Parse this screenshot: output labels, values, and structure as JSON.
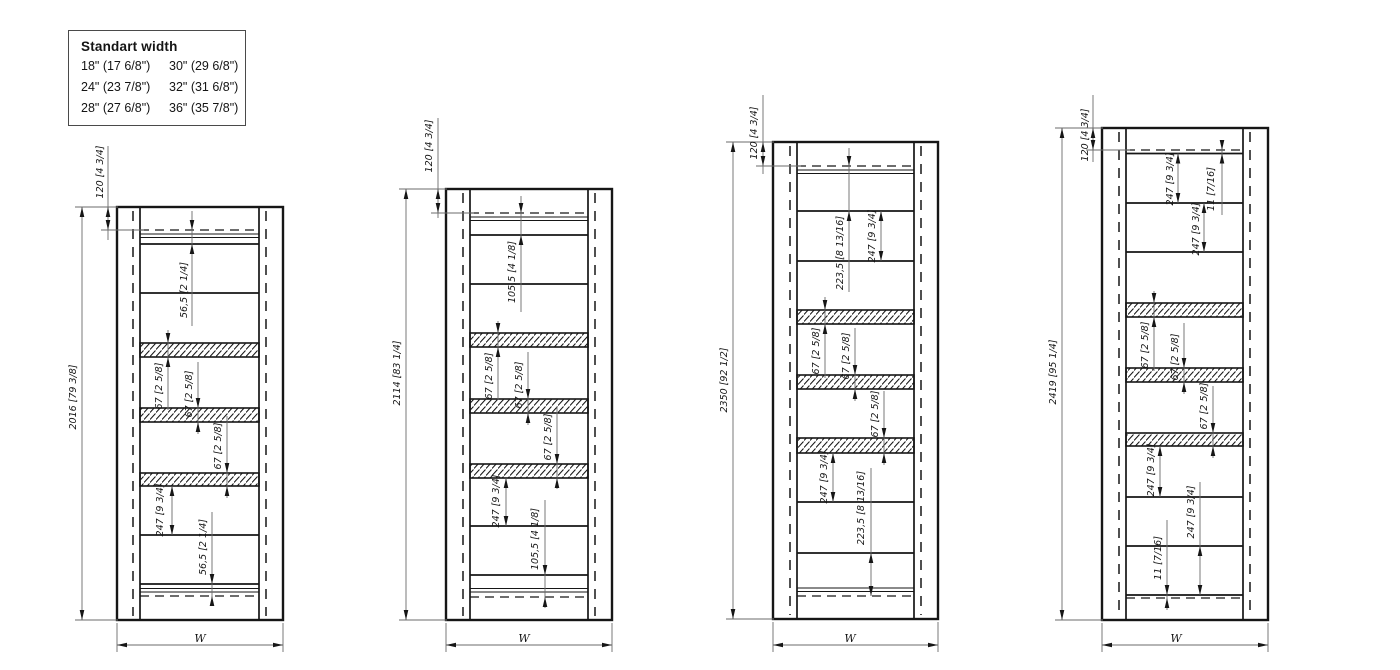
{
  "legend": {
    "title": "Standart width",
    "items": [
      "18\" (17 6/8\")",
      "30\" (29 6/8\")",
      "24\" (23 7/8\")",
      "32\" (31 6/8\")",
      "28\" (27 6/8\")",
      "36\" (35 7/8\")"
    ]
  },
  "drawings": [
    {
      "id": "2016",
      "outer": {
        "x1": 117,
        "y1": 207,
        "x2": 283,
        "y2": 620
      },
      "inner": {
        "x1": 140,
        "x2": 259
      },
      "top": {
        "dashed": 230,
        "strip": [
          234,
          237.5
        ],
        "rail": 244
      },
      "bottom": {
        "rail": 584,
        "strip": [
          588.5,
          592
        ],
        "dashed": 596
      },
      "shelves": [
        293,
        535
      ],
      "bands": [
        [
          343,
          357
        ],
        [
          408,
          422
        ],
        [
          473,
          486
        ]
      ],
      "overall": {
        "label": "2016 [79 3/8]",
        "line_x": 82,
        "text_x": 73,
        "text_cy": 397
      },
      "top_offset": {
        "label": "120 [4 3/4]",
        "line_x": 108,
        "line": [
          146,
          240
        ],
        "text_x": 100,
        "text_cy": 172
      },
      "width_dim": {
        "label": "W",
        "cx": 200,
        "y": 645
      },
      "dims": [
        {
          "label": "56,5 [2 1/4]",
          "line_x": 192,
          "span": [
            230,
            244
          ],
          "mode": "outside",
          "line": [
            211,
            326
          ],
          "text_x": 184,
          "text_cy": 290
        },
        {
          "label": "67 [2 5/8]",
          "line_x": 168,
          "span": [
            343,
            357
          ],
          "mode": "outside",
          "line": [
            330,
            410
          ],
          "text_x": 159,
          "text_cy": 386
        },
        {
          "label": "67 [2 5/8]",
          "line_x": 198,
          "span": [
            408,
            422
          ],
          "mode": "outside",
          "line": [
            362,
            434
          ],
          "text_x": 189,
          "text_cy": 394
        },
        {
          "label": "67 [2 5/8]",
          "line_x": 227,
          "span": [
            473,
            486
          ],
          "mode": "outside",
          "line": [
            416,
            498
          ],
          "text_x": 218,
          "text_cy": 446
        },
        {
          "label": "247 [9 3/4]",
          "line_x": 172,
          "span": [
            486,
            535
          ],
          "mode": "inside",
          "line": [
            486,
            535
          ],
          "text_x": 160,
          "text_cy": 510
        },
        {
          "label": "56,5 [2 1/4]",
          "line_x": 212,
          "span": [
            584,
            596
          ],
          "mode": "outside",
          "line": [
            512,
            606
          ],
          "text_x": 203,
          "text_cy": 547
        }
      ]
    },
    {
      "id": "2114",
      "outer": {
        "x1": 446,
        "y1": 189,
        "x2": 612,
        "y2": 620
      },
      "inner": {
        "x1": 470,
        "x2": 588
      },
      "top": {
        "dashed": 213,
        "strip": [
          217,
          220.5
        ],
        "rail": 235
      },
      "bottom": {
        "rail": 575,
        "strip": [
          588.5,
          592
        ],
        "dashed": 597
      },
      "shelves": [
        284,
        526
      ],
      "bands": [
        [
          333,
          347
        ],
        [
          399,
          413
        ],
        [
          464,
          478
        ]
      ],
      "overall": {
        "label": "2114 [83 1/4]",
        "line_x": 406,
        "text_x": 397,
        "text_cy": 373
      },
      "top_offset": {
        "label": "120 [4 3/4]",
        "line_x": 438,
        "line": [
          118,
          218
        ],
        "text_x": 429,
        "text_cy": 146
      },
      "width_dim": {
        "label": "W",
        "cx": 524,
        "y": 645
      },
      "dims": [
        {
          "label": "105,5 [4 1/8]",
          "line_x": 521,
          "span": [
            213,
            235
          ],
          "mode": "outside",
          "line": [
            196,
            312
          ],
          "text_x": 512,
          "text_cy": 272
        },
        {
          "label": "67 [2 5/8]",
          "line_x": 498,
          "span": [
            333,
            347
          ],
          "mode": "outside",
          "line": [
            321,
            400
          ],
          "text_x": 489,
          "text_cy": 376
        },
        {
          "label": "67 [2 5/8]",
          "line_x": 528,
          "span": [
            399,
            413
          ],
          "mode": "outside",
          "line": [
            352,
            425
          ],
          "text_x": 519,
          "text_cy": 385
        },
        {
          "label": "67 [2 5/8]",
          "line_x": 557,
          "span": [
            464,
            478
          ],
          "mode": "outside",
          "line": [
            407,
            489
          ],
          "text_x": 548,
          "text_cy": 437
        },
        {
          "label": "247 [9 3/4]",
          "line_x": 506,
          "span": [
            478,
            526
          ],
          "mode": "inside",
          "line": [
            478,
            526
          ],
          "text_x": 496,
          "text_cy": 501
        },
        {
          "label": "105,5 [4 1/8]",
          "line_x": 545,
          "span": [
            575,
            597
          ],
          "mode": "outside",
          "line": [
            500,
            608
          ],
          "text_x": 535,
          "text_cy": 539
        }
      ]
    },
    {
      "id": "2350",
      "outer": {
        "x1": 773,
        "y1": 142,
        "x2": 938,
        "y2": 619
      },
      "inner": {
        "x1": 797,
        "x2": 914
      },
      "top": {
        "dashed": 166,
        "strip": [
          170,
          173.5
        ],
        "rail": 211
      },
      "bottom": {
        "rail": 553,
        "strip": [
          588,
          591.5
        ],
        "dashed": 596
      },
      "shelves": [
        261,
        502
      ],
      "bands": [
        [
          310,
          324
        ],
        [
          375,
          389
        ],
        [
          438,
          453
        ]
      ],
      "overall": {
        "label": "2350 [92 1/2]",
        "line_x": 733,
        "text_x": 724,
        "text_cy": 380
      },
      "top_offset": {
        "label": "120 [4 3/4]",
        "line_x": 763,
        "line": [
          95,
          174
        ],
        "text_x": 754,
        "text_cy": 133
      },
      "width_dim": {
        "label": "W",
        "cx": 850,
        "y": 645
      },
      "dims": [
        {
          "label": "223,5 [8 13/16]",
          "line_x": 849,
          "span": [
            166,
            211
          ],
          "mode": "outside",
          "line": [
            148,
            292
          ],
          "text_x": 840,
          "text_cy": 253
        },
        {
          "label": "247 [9 3/4]",
          "line_x": 881,
          "span": [
            211,
            261
          ],
          "mode": "inside",
          "line": [
            211,
            261
          ],
          "text_x": 872,
          "text_cy": 236
        },
        {
          "label": "67 [2 5/8]",
          "line_x": 825,
          "span": [
            310,
            324
          ],
          "mode": "outside",
          "line": [
            297,
            378
          ],
          "text_x": 816,
          "text_cy": 351
        },
        {
          "label": "67 [2 5/8]",
          "line_x": 855,
          "span": [
            375,
            389
          ],
          "mode": "outside",
          "line": [
            328,
            401
          ],
          "text_x": 846,
          "text_cy": 356
        },
        {
          "label": "67 [2 5/8]",
          "line_x": 884,
          "span": [
            438,
            453
          ],
          "mode": "outside",
          "line": [
            391,
            465
          ],
          "text_x": 875,
          "text_cy": 414
        },
        {
          "label": "247 [9 3/4]",
          "line_x": 833,
          "span": [
            453,
            502
          ],
          "mode": "inside",
          "line": [
            453,
            502
          ],
          "text_x": 824,
          "text_cy": 477
        },
        {
          "label": "223,5 [8 13/16]",
          "line_x": 871,
          "span": [
            553,
            596
          ],
          "mode": "inside",
          "line": [
            468,
            596
          ],
          "text_x": 861,
          "text_cy": 508
        }
      ]
    },
    {
      "id": "2419",
      "outer": {
        "x1": 1102,
        "y1": 128,
        "x2": 1268,
        "y2": 620
      },
      "inner": {
        "x1": 1126,
        "x2": 1243
      },
      "top": {
        "dashed": 150,
        "rail": 153.5
      },
      "bottom": {
        "rail": 595,
        "dashed": 598
      },
      "shelves": [
        203,
        252,
        497,
        546
      ],
      "bands": [
        [
          303,
          317
        ],
        [
          368,
          382
        ],
        [
          433,
          446
        ]
      ],
      "overall": {
        "label": "2419 [95 1/4]",
        "line_x": 1062,
        "text_x": 1053,
        "text_cy": 372
      },
      "top_offset": {
        "label": "120 [4 3/4]",
        "line_x": 1093,
        "line": [
          95,
          162
        ],
        "text_x": 1085,
        "text_cy": 135
      },
      "width_dim": {
        "label": "W",
        "cx": 1176,
        "y": 645
      },
      "dims": [
        {
          "label": "247 [9 3/4]",
          "line_x": 1178,
          "span": [
            153.5,
            203
          ],
          "mode": "inside",
          "line": [
            153.5,
            203
          ],
          "text_x": 1170,
          "text_cy": 179
        },
        {
          "label": "247 [9 3/4]",
          "line_x": 1204,
          "span": [
            203,
            252
          ],
          "mode": "inside",
          "line": [
            203,
            252
          ],
          "text_x": 1196,
          "text_cy": 229
        },
        {
          "label": "11 [7/16]",
          "line_x": 1222,
          "span": [
            150,
            153.5
          ],
          "mode": "outside",
          "line": [
            140,
            215
          ],
          "text_x": 1211,
          "text_cy": 189
        },
        {
          "label": "67 [2 5/8]",
          "line_x": 1154,
          "span": [
            303,
            317
          ],
          "mode": "outside",
          "line": [
            291,
            371
          ],
          "text_x": 1145,
          "text_cy": 345
        },
        {
          "label": "67 [2 5/8]",
          "line_x": 1184,
          "span": [
            368,
            382
          ],
          "mode": "outside",
          "line": [
            323,
            394
          ],
          "text_x": 1175,
          "text_cy": 357
        },
        {
          "label": "67 [2 5/8]",
          "line_x": 1213,
          "span": [
            433,
            446
          ],
          "mode": "outside",
          "line": [
            386,
            458
          ],
          "text_x": 1204,
          "text_cy": 406
        },
        {
          "label": "247 [9 3/4]",
          "line_x": 1160,
          "span": [
            446,
            497
          ],
          "mode": "inside",
          "line": [
            446,
            497
          ],
          "text_x": 1151,
          "text_cy": 470
        },
        {
          "label": "247 [9 3/4]",
          "line_x": 1200,
          "span": [
            546,
            595
          ],
          "mode": "inside",
          "line": [
            482,
            595
          ],
          "text_x": 1191,
          "text_cy": 512
        },
        {
          "label": "11 [7/16]",
          "line_x": 1167,
          "span": [
            595,
            598
          ],
          "mode": "outside",
          "line": [
            520,
            610
          ],
          "text_x": 1158,
          "text_cy": 558
        }
      ]
    }
  ]
}
